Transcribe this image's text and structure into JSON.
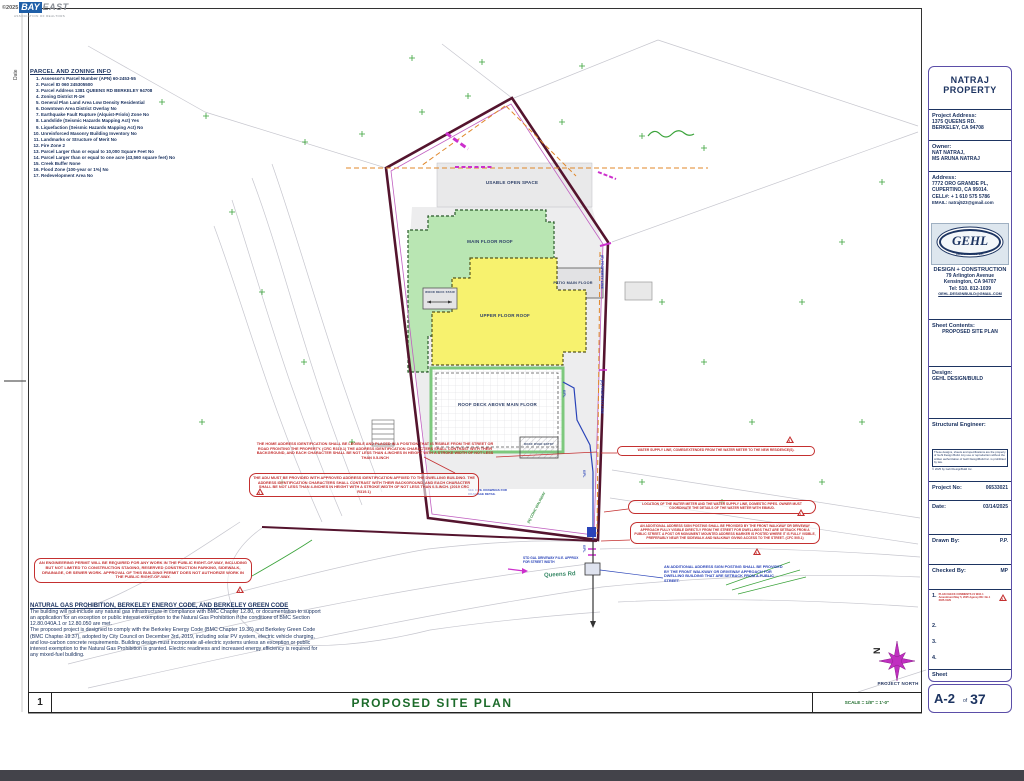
{
  "header": {
    "copyright": "©2025",
    "logo_primary": "BAY",
    "logo_secondary": "EAST",
    "tagline": "ASSOCIATION OF REALTORS"
  },
  "edge": {
    "date_label": "Date"
  },
  "parcel_info": {
    "title": "PARCEL AND ZONING INFO",
    "items": [
      "Assessor's Parcel Number (APN) 60-2453-55",
      "Parcel ID 060 245305500",
      "Parcel Address 1381 QUEENS RD BERKELEY 94708",
      "Zoning District R-1H",
      "General Plan Land Area Low Density Residential",
      "Downtown Area District Overlay No",
      "Earthquake Fault Rupture (Alquist-Priolo) Zone No",
      "Landslide (Seismic Hazards Mapping Act) Yes",
      "Liquefaction (Seismic Hazards Mapping Act) No",
      "Unreinforced Masonry Building Inventory No",
      "Landmarks or Structure of Merit No",
      "Fire Zone 2",
      "Parcel Larger than or equal to 10,000 Square Feet No",
      "Parcel Larger than or equal to one acre (43,560 square feet) No",
      "Creek Buffer None",
      "Flood Zone (100-year or 1%) No",
      "Redevelopment Area No"
    ]
  },
  "plan": {
    "areas": {
      "usable_open_space": "USABLE OPEN SPACE",
      "main_floor_roof": "MAIN FLOOR ROOF",
      "patio_main_floor": "PATIO MAIN FLOOR",
      "upper_floor_roof": "UPPER FLOOR ROOF",
      "roof_deck": "ROOF DECK ABOVE MAIN FLOOR",
      "wood_deck": "WOOD DECK STAIR",
      "roof_over": "ROOF OVER ENTRY"
    },
    "street": "Queens Rd",
    "walkway_note": "(N) CONC WALKWAY",
    "driveway_note": "STD GAL DRIVEWAY P.U.E. APPROX FOR STREET WIDTH",
    "drainage_note": "SEE CIVIL DRAWINGS FOR DRAINAGE DETAIL",
    "property_line_note": "(E) PROPERTY LINE",
    "dim_label": "6'/PL",
    "north_label": "PROJECT NORTH",
    "north_letter": "N",
    "triangle_label": "1",
    "annotations": {
      "home_address": "THE HOME ADDRESS IDENTIFICATION SHALL BE LEGIBLE AND PLACED IN A POSITION THAT IS VISIBLE FROM THE STREET OR ROAD FRONTING THE PROPERTY. (CRC R319.1) THE ADDRESS IDENTIFICATION CHARACTERS SHALL CONTRAST WITH THEIR BACKGROUND, AND EACH CHARACTER SHALL BE NOT LESS THAN 4-INCHES IN HEIGHT WITH A STROKE WIDTH OF NOT LESS THAN 0.5-INCH",
      "adu_address": "THE ADU MUST BE PROVIDED WITH APPROVED ADDRESS IDENTIFICATION AFFIXED TO THE DWELLING BUILDING. THE ADDRESS IDENTIFICATION CHARACTERS SHALL CONTRAST WITH THEIR BACKGROUND, AND EACH CHARACTER SHALL BE NOT LESS THAN 4-INCHES IN HEIGHT WITH A STROKE WIDTH OF NOT LESS THAN 0.5-INCH. (2019 CRC R319.1)",
      "water_supply": "WATER SUPPLY LINE, COMES/EXTENDED FROM THE WATER METER TO THE NEW RESIDENCE(S).",
      "water_meter": "LOCATION OF THE WATER METER AND THE WATER SUPPLY LINE, DOMESTIC PIPES. OWNER MUST COORDINATE THE DETAILS OF THE WATER METER WITH EBMUD.",
      "additional_address_red": "AN ADDITIONAL ADDRESS SIGN POSTING SHALL BE PROVIDED BY THE FRONT WALKWAY OR DRIVEWAY APPROACH FULLY VISIBLE DIRECTLY FROM THE STREET FOR DWELLINGS THAT ARE SETBACK FROM A PUBLIC STREET. A POST OR MONUMENT MOUNTED ADDRESS MARKER IS POSTED WHERE IT IS FULLY VISIBLE, PREFERABLY NEAR THE SIDEWALK AND WALKWAY GIVING ACCESS TO THE STREET. (CFC 505.1)",
      "additional_address_blue": "AN ADDITIONAL ADDRESS SIGN POSTING SHALL BE PROVIDED BY THE FRONT WALKWAY OR DRIVEWAY APPROACH FOR DWELLING BUILDING THAT ARE SETBACK FROM A PUBLIC STREET.",
      "engineering_permit": "AN ENGINEERING PERMIT WILL BE REQUIRED FOR ANY WORK IN THE PUBLIC RIGHT-OF-WAY, INCLUDING BUT NOT LIMITED TO CONSTRUCTION STAGING, RESERVED CONSTRUCTION PARKING, SIDEWALK, DRAINAGE, OR SEWER WORK. APPROVAL OF THIS BUILDING PERMIT DOES NOT AUTHORIZE WORK IN THE PUBLIC RIGHT-OF-WAY."
    }
  },
  "gas_note": {
    "title": "NATURAL GAS PROHIBITION, BERKELEY ENERGY CODE, AND BERKELEY GREEN CODE",
    "para1": "The building will not include any natural gas infrastructure in compliance with BMC Chapter 12.80, or documentation to support an application for an exception or public interest exemption to the Natural Gas Prohibition if the conditions of BMC Section 12.80.040A.1 or 12.80.050 are met.",
    "para2": "The proposed project is designed to comply with the Berkeley Energy Code (BMC Chapter 19.36) and Berkeley Green Code (BMC Chapter 19.37), adopted by City Council on December 3rd, 2019, including solar PV system, electric vehicle charging, and low-carbon concrete requirements. Building design must incorporate all-electric systems unless an exception or public interest exemption to the Natural Gas Prohibition is granted. Electric readiness and increased energy efficiency is required for any mixed-fuel building."
  },
  "titlebar": {
    "number": "1",
    "title": "PROPOSED SITE PLAN",
    "scale": "SCALE = 1/8\" = 1'-0\""
  },
  "titleblock": {
    "title": "NATRAJ PROPERTY",
    "project_address_label": "Project Address:",
    "project_address_1": "1375 QUEENS RD.",
    "project_address_2": "BERKELEY, CA 94708",
    "owner_label": "Owner:",
    "owner_1": "NAT NATRAJ,",
    "owner_2": "MS ARUNA NATRAJ",
    "address_label": "Address:",
    "address_1": "7772 ORO GRANDE PL,",
    "address_2": "CUPERTINO, CA 95014.",
    "address_3": "CELL#: + 1 610 575 5786",
    "address_4": "EMAIL: natraj523@gmail.com",
    "logo_text": "GEHL",
    "logo_sub": "DESIGN BUILD Inc.",
    "firm_line_1": "DESIGN + CONSTRUCTION",
    "firm_line_2": "79 Arlington Avenue",
    "firm_line_3": "Kensington, CA 94707",
    "firm_line_4": "Tel: 510. 812-1039",
    "firm_line_5": "GEHL.DESIGNBUILD@GMAIL.COM",
    "sheet_contents_label": "Sheet Contents:",
    "sheet_contents": "PROPOSED SITE PLAN",
    "design_label": "Design:",
    "design_value": "GEHL DESIGN/BUILD",
    "structural_label": "Structural Engineer:",
    "disclaimer": "These designs, sheets and specifications are the property of Gehl Design Build. Any use or reproduction without the written authorization of Gehl DesignBuild Inc. is prohibited by law.",
    "disclaimer_2": "© 2025 by Gehl DesignBuild Inc.",
    "project_no_label": "Project No:",
    "project_no": "06533021",
    "date_label": "Date:",
    "date": "03/14/2025",
    "drawn_label": "Drawn By:",
    "drawn": "P.P.",
    "checked_label": "Checked By:",
    "checked": "MP",
    "revisions": [
      {
        "num": "1.",
        "text": "PLAN CHECK COMMENTS #1 With 1 Amendment May 5, 2025 Agency RE: No.1 2025-0129"
      },
      {
        "num": "2.",
        "text": ""
      },
      {
        "num": "3.",
        "text": ""
      },
      {
        "num": "4.",
        "text": ""
      }
    ],
    "sheet_label": "Sheet",
    "sheet_number": "A-2",
    "sheet_of": "of",
    "sheet_total": "37"
  }
}
